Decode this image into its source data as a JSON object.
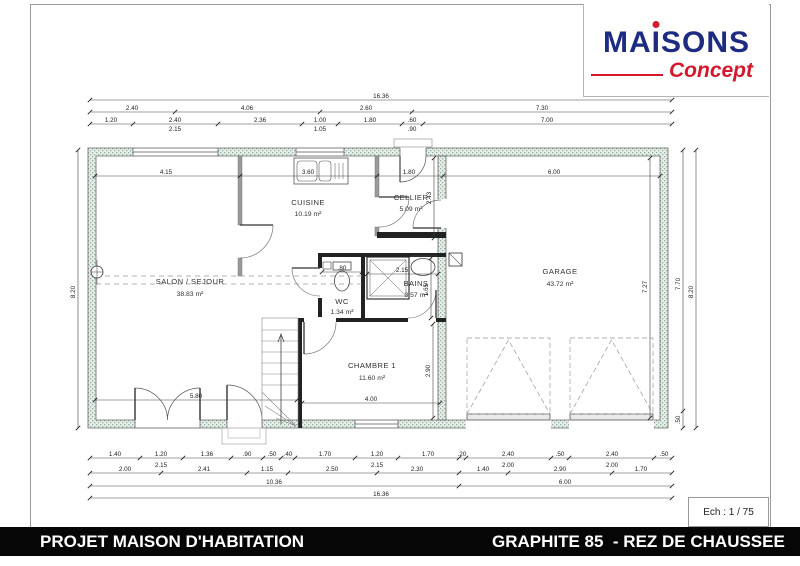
{
  "logo": {
    "part1": "MA",
    "part2": "I",
    "part3": "SONS",
    "concept": "Concept",
    "blue": "#1d2c80",
    "red": "#d5182d"
  },
  "titlebar": {
    "left": "PROJET MAISON D'HABITATION",
    "right": "GRAPHITE 85  - REZ DE CHAUSSEE",
    "bg": "#060606",
    "text_color": "#ffffff"
  },
  "scale": "Ech : 1 / 75",
  "rooms": [
    {
      "name": "CUISINE",
      "area": "10.19 m²"
    },
    {
      "name": "CELLIER",
      "area": "5.09 m²"
    },
    {
      "name": "SALON / SEJOUR",
      "area": "38.83 m²"
    },
    {
      "name": "WC",
      "area": "1.34 m²"
    },
    {
      "name": "BAINS",
      "area": "3.57 m²"
    },
    {
      "name": "CHAMBRE 1",
      "area": "11.60 m²"
    },
    {
      "name": "GARAGE",
      "area": "43.72 m²"
    }
  ],
  "dim_labels": [
    {
      "t": "16.36",
      "x": 381,
      "y": 98
    },
    {
      "t": "2.40",
      "x": 132,
      "y": 110
    },
    {
      "t": "4.06",
      "x": 247,
      "y": 110
    },
    {
      "t": "2.60",
      "x": 366,
      "y": 110
    },
    {
      "t": "7.30",
      "x": 542,
      "y": 110
    },
    {
      "t": "1.20",
      "x": 111,
      "y": 122
    },
    {
      "t": "2.40",
      "x": 175,
      "y": 122
    },
    {
      "t": "2.36",
      "x": 260,
      "y": 122
    },
    {
      "t": "1.00",
      "x": 320,
      "y": 122
    },
    {
      "t": "1.80",
      "x": 370,
      "y": 122
    },
    {
      "t": ".60",
      "x": 412,
      "y": 122
    },
    {
      "t": "7.00",
      "x": 547,
      "y": 122
    },
    {
      "t": "2.15",
      "x": 175,
      "y": 131
    },
    {
      "t": "1.05",
      "x": 320,
      "y": 131
    },
    {
      "t": ".90",
      "x": 412,
      "y": 131
    },
    {
      "t": "4.15",
      "x": 166,
      "y": 174
    },
    {
      "t": "3.60",
      "x": 308,
      "y": 174
    },
    {
      "t": "1.80",
      "x": 409,
      "y": 174
    },
    {
      "t": "6.00",
      "x": 554,
      "y": 174
    },
    {
      "t": "5.80",
      "x": 196,
      "y": 398
    },
    {
      "t": "4.00",
      "x": 371,
      "y": 401
    },
    {
      "t": "2.15",
      "x": 402,
      "y": 272
    },
    {
      "t": ".80",
      "x": 342,
      "y": 270
    },
    {
      "t": "2.90",
      "x": 430,
      "y": 371,
      "r": -90
    },
    {
      "t": "1.65",
      "x": 428,
      "y": 290,
      "r": -90
    },
    {
      "t": "2.43",
      "x": 431,
      "y": 198,
      "r": -90
    },
    {
      "t": "7.27",
      "x": 647,
      "y": 287,
      "r": -90
    },
    {
      "t": "1.40",
      "x": 115,
      "y": 456
    },
    {
      "t": "1.20",
      "x": 161,
      "y": 456
    },
    {
      "t": "1.36",
      "x": 207,
      "y": 456
    },
    {
      "t": ".90",
      "x": 247,
      "y": 456
    },
    {
      "t": ".50",
      "x": 272,
      "y": 456
    },
    {
      "t": ".40",
      "x": 288,
      "y": 456
    },
    {
      "t": "1.70",
      "x": 325,
      "y": 456
    },
    {
      "t": "1.20",
      "x": 377,
      "y": 456
    },
    {
      "t": "1.70",
      "x": 428,
      "y": 456
    },
    {
      "t": ".20",
      "x": 462,
      "y": 456
    },
    {
      "t": "2.40",
      "x": 508,
      "y": 456
    },
    {
      "t": ".50",
      "x": 560,
      "y": 456
    },
    {
      "t": "2.40",
      "x": 612,
      "y": 456
    },
    {
      "t": ".50",
      "x": 664,
      "y": 456
    },
    {
      "t": "2.15",
      "x": 161,
      "y": 467
    },
    {
      "t": "2.15",
      "x": 377,
      "y": 467
    },
    {
      "t": "2.00",
      "x": 508,
      "y": 467
    },
    {
      "t": "2.00",
      "x": 612,
      "y": 467
    },
    {
      "t": "2.00",
      "x": 125,
      "y": 471
    },
    {
      "t": "2.41",
      "x": 204,
      "y": 471
    },
    {
      "t": "1.15",
      "x": 267,
      "y": 471
    },
    {
      "t": "2.50",
      "x": 332,
      "y": 471
    },
    {
      "t": "2.30",
      "x": 417,
      "y": 471
    },
    {
      "t": "1.40",
      "x": 483,
      "y": 471
    },
    {
      "t": "2.90",
      "x": 560,
      "y": 471
    },
    {
      "t": "1.70",
      "x": 641,
      "y": 471
    },
    {
      "t": "10.36",
      "x": 274,
      "y": 484
    },
    {
      "t": "6.00",
      "x": 565,
      "y": 484
    },
    {
      "t": "16.36",
      "x": 381,
      "y": 496
    },
    {
      "t": "8.20",
      "x": 75,
      "y": 292,
      "r": -90
    },
    {
      "t": "7.70",
      "x": 680,
      "y": 284,
      "r": -90
    },
    {
      "t": ".50",
      "x": 680,
      "y": 420,
      "r": -90
    },
    {
      "t": "8.20",
      "x": 693,
      "y": 292,
      "r": -90
    }
  ]
}
